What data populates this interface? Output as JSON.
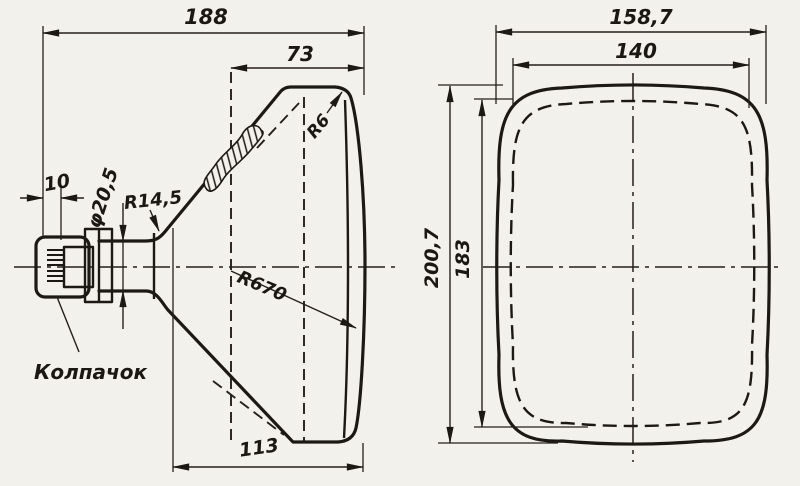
{
  "drawing": {
    "ink_color": "#1c1914",
    "paper_color": "#f3f1ec",
    "side_view": {
      "dim_total_length": "188",
      "dim_screen_depth": "73",
      "dim_cap_offset": "10",
      "dim_neck_diameter": "φ20,5",
      "dim_neck_fillet_radius": "R14,5",
      "dim_face_corner_radius": "R6",
      "dim_face_sphere_radius": "R670",
      "dim_funnel_length": "113",
      "cap_label": "Колпачок"
    },
    "front_view": {
      "dim_overall_width": "158,7",
      "dim_screen_width": "140",
      "dim_overall_height": "200,7",
      "dim_screen_height": "183"
    }
  }
}
